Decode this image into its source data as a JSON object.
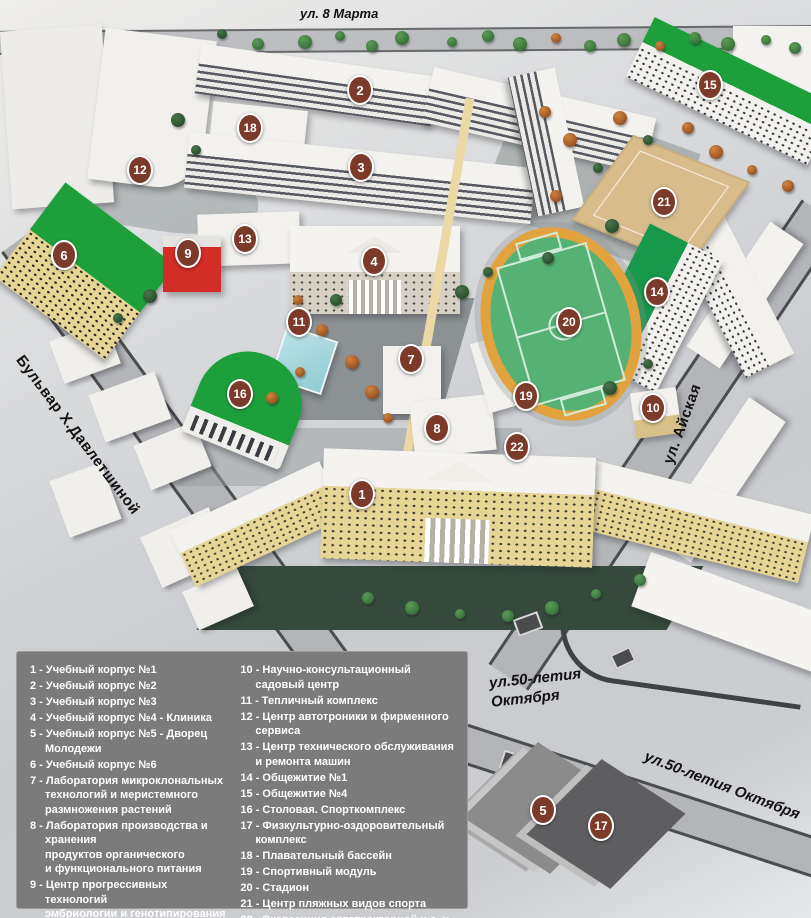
{
  "streets": {
    "top": "ул. 8 Марта",
    "left": "Бульвар Х.Давлетшиной",
    "right": "ул. Айская",
    "bottom1_line1": "ул.50-летия",
    "bottom1_line2": "Октября",
    "bottom2": "ул.50-летия Октября"
  },
  "markers": [
    {
      "n": "1",
      "x": 362,
      "y": 494
    },
    {
      "n": "2",
      "x": 360,
      "y": 90
    },
    {
      "n": "3",
      "x": 361,
      "y": 167
    },
    {
      "n": "4",
      "x": 374,
      "y": 261
    },
    {
      "n": "5",
      "x": 543,
      "y": 810
    },
    {
      "n": "6",
      "x": 64,
      "y": 255
    },
    {
      "n": "7",
      "x": 411,
      "y": 359
    },
    {
      "n": "8",
      "x": 437,
      "y": 428
    },
    {
      "n": "9",
      "x": 188,
      "y": 253
    },
    {
      "n": "10",
      "x": 653,
      "y": 408
    },
    {
      "n": "11",
      "x": 299,
      "y": 322
    },
    {
      "n": "12",
      "x": 140,
      "y": 170
    },
    {
      "n": "13",
      "x": 245,
      "y": 239
    },
    {
      "n": "14",
      "x": 657,
      "y": 292
    },
    {
      "n": "15",
      "x": 710,
      "y": 85
    },
    {
      "n": "16",
      "x": 240,
      "y": 394
    },
    {
      "n": "17",
      "x": 601,
      "y": 826
    },
    {
      "n": "18",
      "x": 250,
      "y": 128
    },
    {
      "n": "19",
      "x": 526,
      "y": 396
    },
    {
      "n": "20",
      "x": 569,
      "y": 322
    },
    {
      "n": "21",
      "x": 664,
      "y": 202
    },
    {
      "n": "22",
      "x": 517,
      "y": 447
    }
  ],
  "legend": {
    "left": [
      {
        "num": "1",
        "lines": [
          "Учебный корпус №1"
        ]
      },
      {
        "num": "2",
        "lines": [
          "Учебный корпус №2"
        ]
      },
      {
        "num": "3",
        "lines": [
          "Учебный корпус №3"
        ]
      },
      {
        "num": "4",
        "lines": [
          "Учебный корпус №4 - Клиника"
        ]
      },
      {
        "num": "5",
        "lines": [
          "Учебный корпус №5 - Дворец Молодежи"
        ]
      },
      {
        "num": "6",
        "lines": [
          "Учебный корпус №6"
        ]
      },
      {
        "num": "7",
        "lines": [
          "Лаборатория микроклональных",
          "технологий и меристемного",
          "размножения растений"
        ]
      },
      {
        "num": "8",
        "lines": [
          "Лаборатория производства и хранения",
          "продуктов органического",
          "и функционального питания"
        ]
      },
      {
        "num": "9",
        "lines": [
          "Центр прогрессивных технологий",
          "эмбриологии и генотипирования"
        ]
      }
    ],
    "right": [
      {
        "num": "10",
        "lines": [
          "Научно-консультационный садовый центр"
        ]
      },
      {
        "num": "11",
        "lines": [
          "Тепличный комплекс"
        ]
      },
      {
        "num": "12",
        "lines": [
          "Центр автотроники и фирменного сервиса"
        ]
      },
      {
        "num": "13",
        "lines": [
          "Центр технического обслуживания",
          "и ремонта машин"
        ]
      },
      {
        "num": "14",
        "lines": [
          "Общежитие №1"
        ]
      },
      {
        "num": "15",
        "lines": [
          "Общежитие №4"
        ]
      },
      {
        "num": "16",
        "lines": [
          "Столовая. Спорткомплекс"
        ]
      },
      {
        "num": "17",
        "lines": [
          "Физкультурно-оздоровительный комплекс"
        ]
      },
      {
        "num": "18",
        "lines": [
          "Плавательный бассейн"
        ]
      },
      {
        "num": "19",
        "lines": [
          "Спортивный модуль"
        ]
      },
      {
        "num": "20",
        "lines": [
          "Стадион"
        ]
      },
      {
        "num": "21",
        "lines": [
          "Центр пляжных видов спорта"
        ]
      },
      {
        "num": "22",
        "lines": [
          "Экспозиция автотракторной и с.-х. техники"
        ]
      }
    ]
  },
  "colors": {
    "marker": "#7b3a2a",
    "legend": "#7b7b7b",
    "green": "#1da03c",
    "field": "#56b274",
    "track": "#e2a33f",
    "sand": "#d9bc8c",
    "red": "#d22d26",
    "teal": "#8fccd4",
    "yellow": "#e7d596"
  }
}
